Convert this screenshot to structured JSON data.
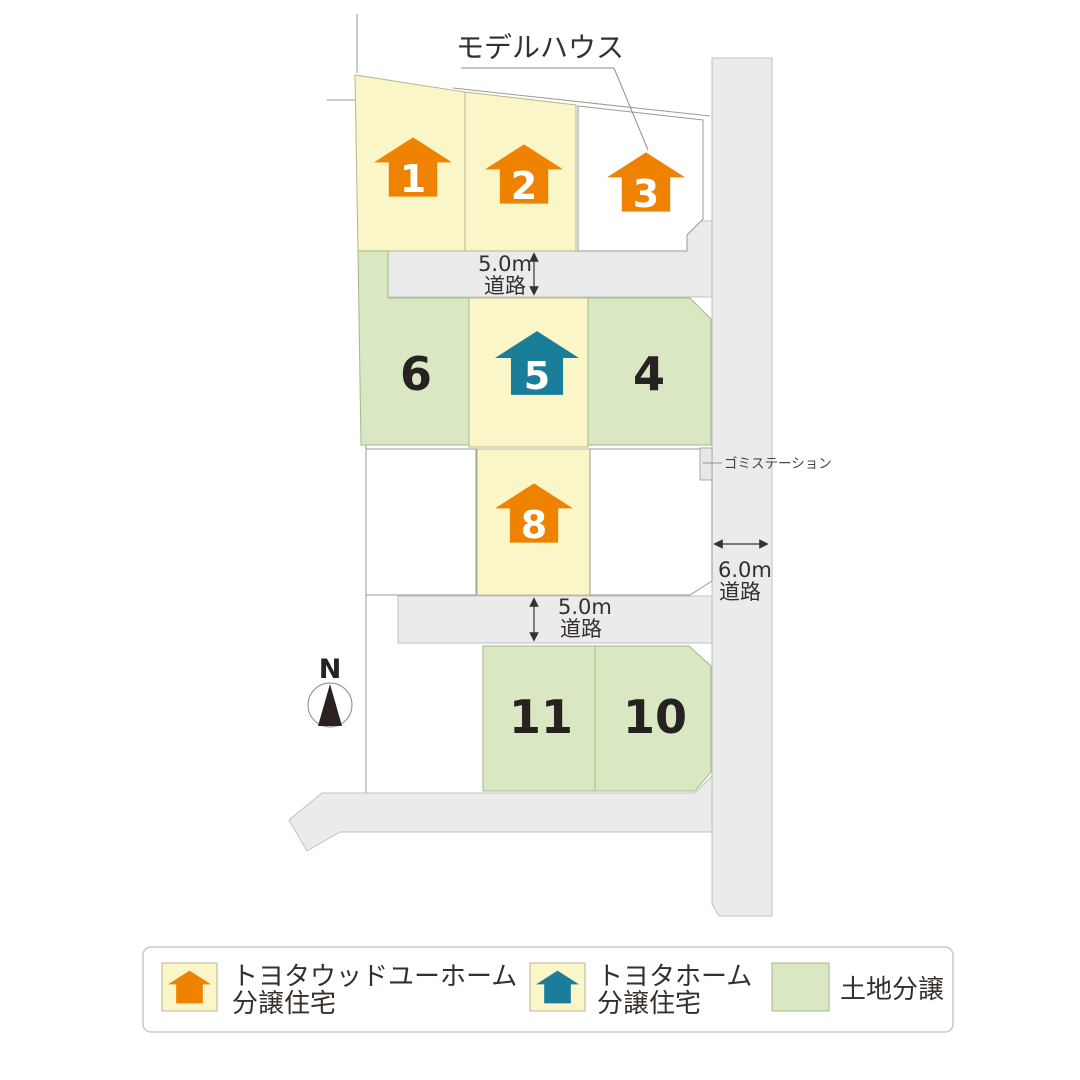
{
  "map": {
    "model_house_label": "モデルハウス",
    "garbage_station_label": "ゴミステーション",
    "north_label": "N",
    "road_labels": {
      "top": {
        "width": "5.0m",
        "type": "道路"
      },
      "bottom": {
        "width": "5.0m",
        "type": "道路"
      },
      "right": {
        "width": "6.0m",
        "type": "道路"
      }
    },
    "lots": {
      "lot_1": "1",
      "lot_2": "2",
      "lot_3": "3",
      "lot_4": "4",
      "lot_5": "5",
      "lot_6": "6",
      "lot_8": "8",
      "lot_10": "10",
      "lot_11": "11"
    }
  },
  "legend": {
    "wood_you_home": {
      "line1": "トヨタウッドユーホーム",
      "line2": "分譲住宅"
    },
    "toyota_home": {
      "line1": "トヨタホーム",
      "line2": "分譲住宅"
    },
    "land": {
      "label": "土地分譲"
    }
  },
  "colors": {
    "orange_house": "#EF8200",
    "teal_house": "#1A7E9B",
    "lot_yellow": "#FAF6C8",
    "lot_green": "#D9E7C3",
    "road_gray": "#EBEBEC"
  }
}
